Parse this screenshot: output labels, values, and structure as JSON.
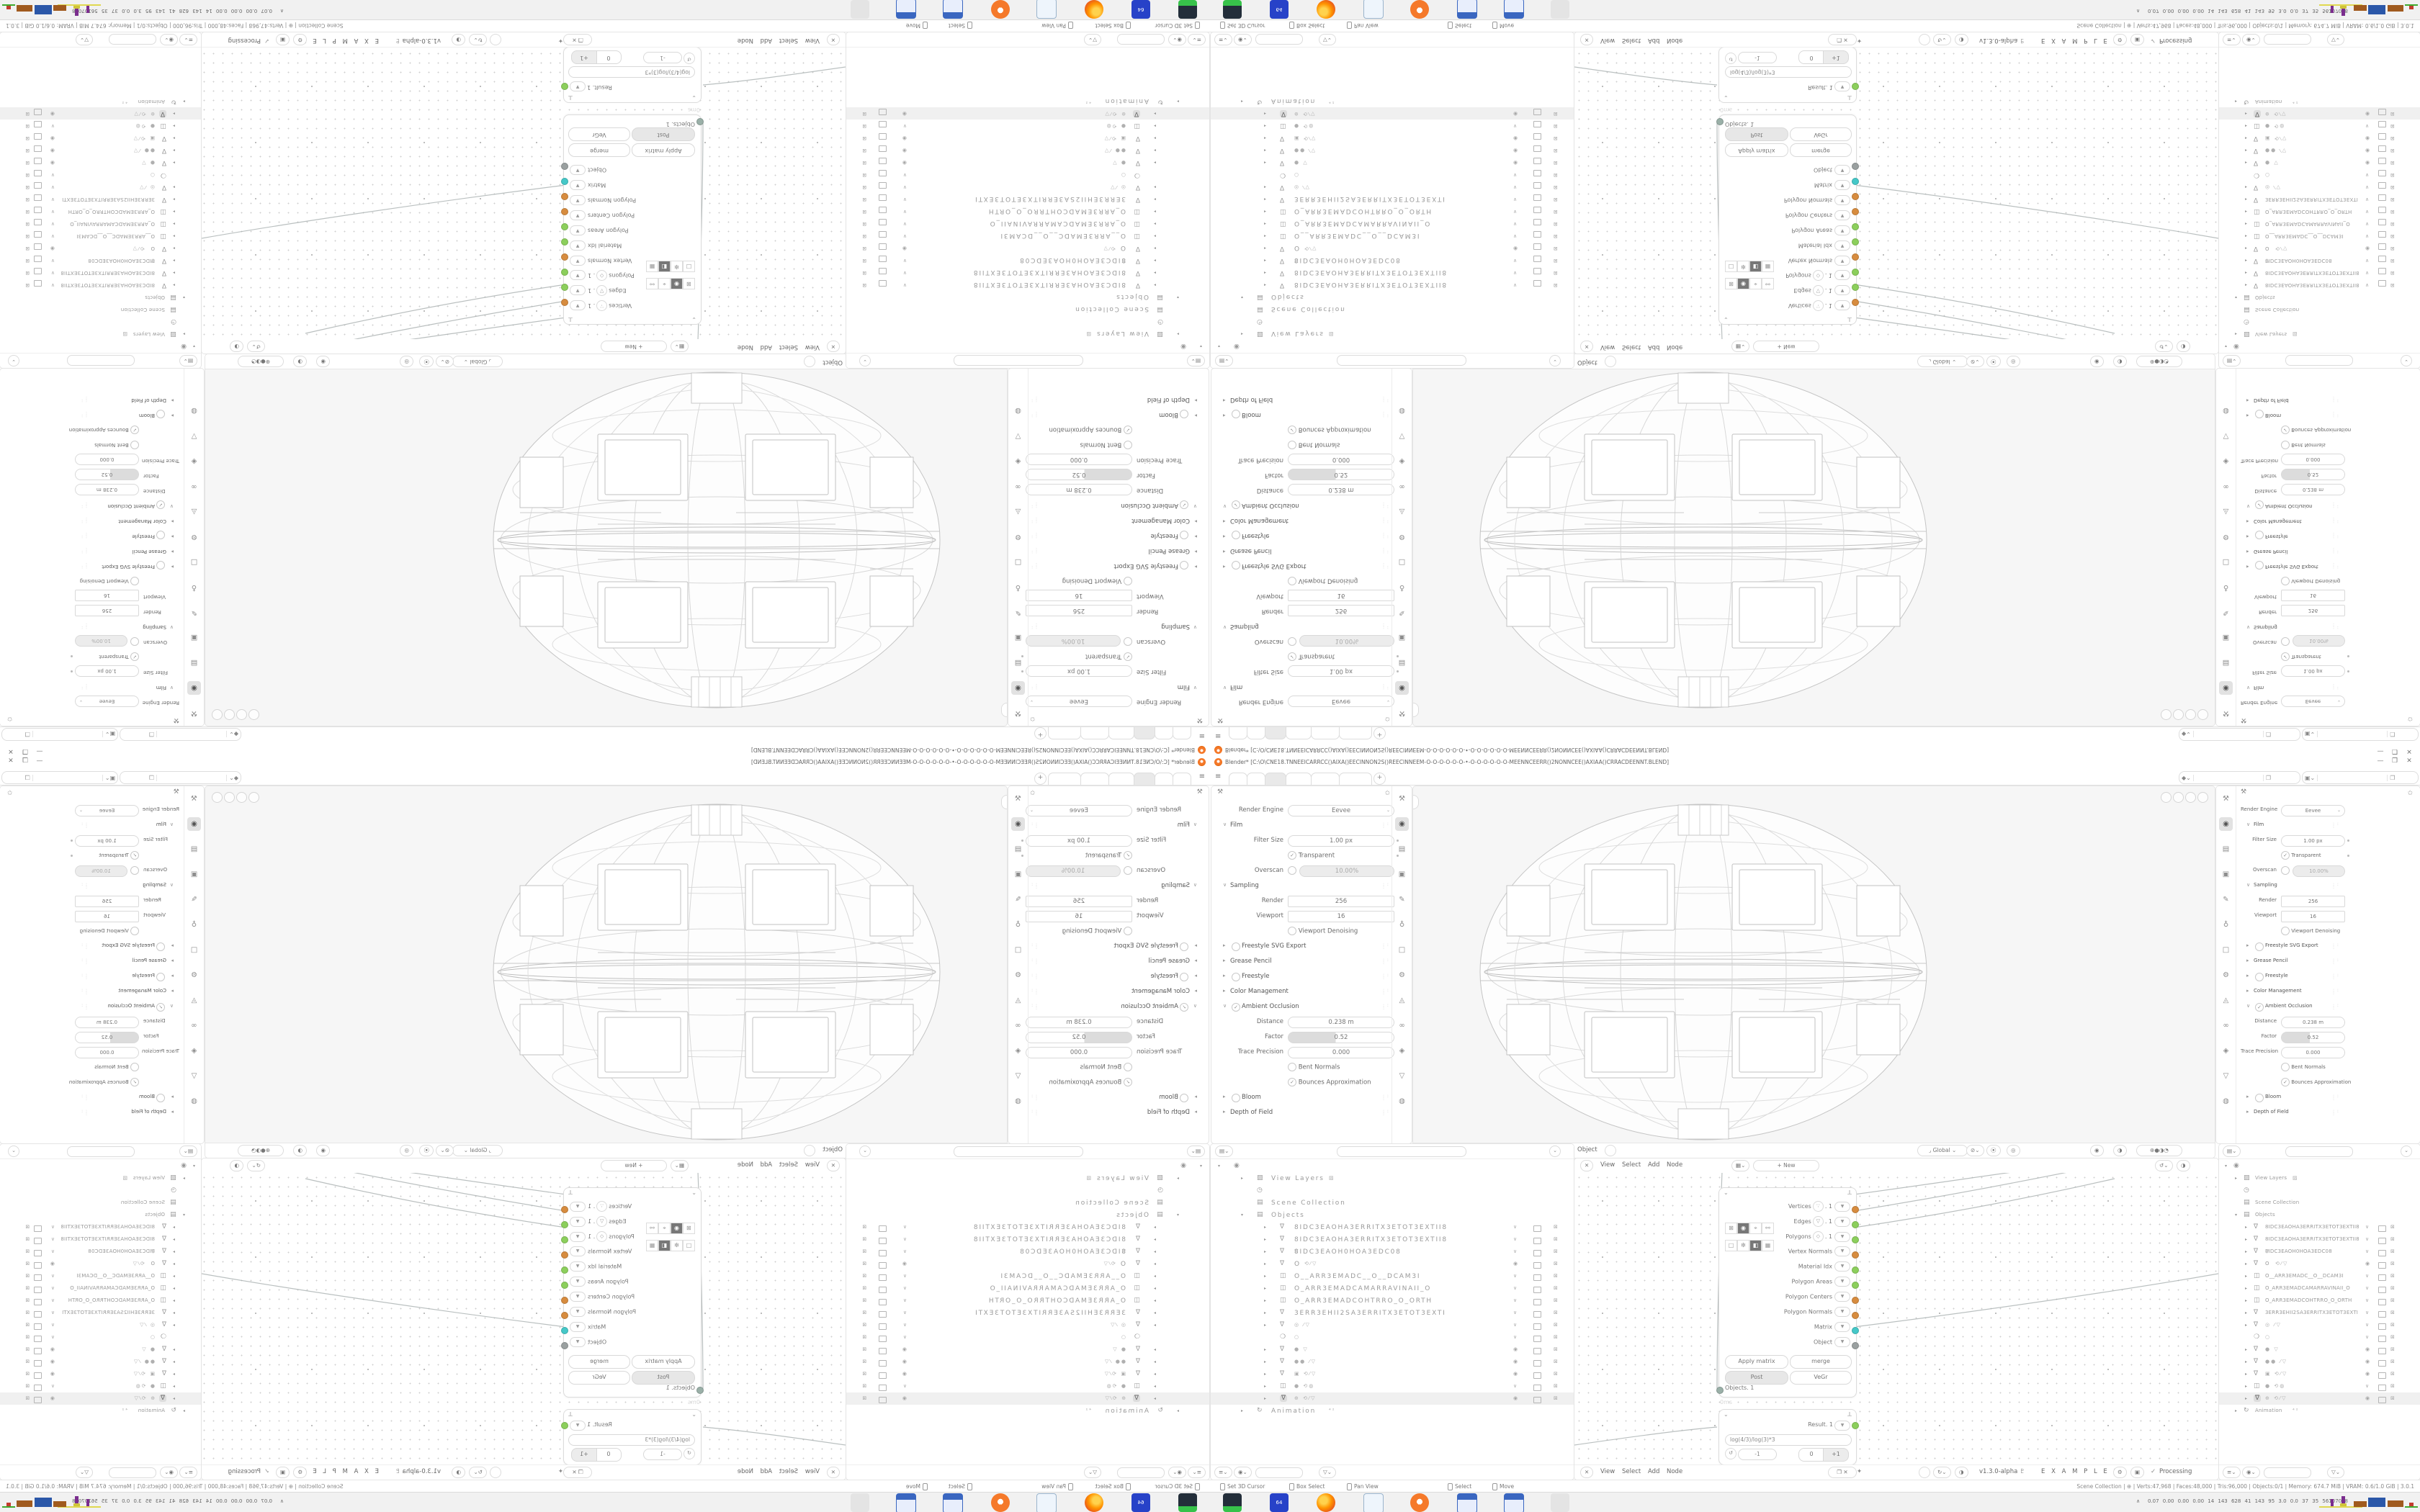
{
  "meta": {
    "app": "Blender 3.0.1",
    "composition": "2x2 mirrored tiling of one 1680x1050 Blender window",
    "quadrants": {
      "top_left": "rotated-180",
      "top_right": "flipped-vertical",
      "bottom_left": "flipped-horizontal",
      "bottom_right": "original"
    }
  },
  "colors": {
    "blender_orange": "#f5792a",
    "socket_orange": "#d78c3f",
    "socket_green": "#8ccf5c",
    "socket_teal": "#45c8c8",
    "socket_gray": "#9aa0a0",
    "taskbar_bg": "#f1f1f1",
    "area_border": "#e4e4e4"
  },
  "window": {
    "title": "Blender* [C:\\O\\CNE18.TNNEEICARRCC()AIXA()EECINNON2S()REECINNEEM-O-O-O-O-O-O-•-O-O-O-O-O-O-MEENNCEERR()2NONNCEE()AXIAA()CRRACDEENNT.BLEND]",
    "controls": {
      "minimize": "—",
      "restore": "❐",
      "close": "✕"
    }
  },
  "topbar": {
    "menu_icon": "≡",
    "tabs": [
      {
        "label": "",
        "active": false
      },
      {
        "label": "",
        "active": false
      },
      {
        "label": "",
        "active": true
      },
      {
        "label": "",
        "active": false
      },
      {
        "label": "",
        "active": false
      },
      {
        "label": "",
        "active": false
      }
    ],
    "add_tab": "+",
    "scene_selector": {
      "value": "",
      "icon": "scene-icon",
      "copy_icon": "copy-icon"
    },
    "viewlayer_selector": {
      "value": "",
      "icon": "viewlayer-icon",
      "copy_icon": "copy-icon"
    }
  },
  "icons": {
    "chev": "⌄",
    "pin": "✩",
    "pin_filled": "✦",
    "tool": "⚒",
    "grip": ": : :",
    "editor": "✙",
    "snap": "⚓",
    "magnet": "⦿",
    "proportional": "◎",
    "overlay1": "◉",
    "overlay2": "◑",
    "shading": "⊕●◑◔",
    "tree_x": "✕",
    "dna": "♇",
    "check": "✓",
    "copy": "❐",
    "reset": "↺",
    "wrench": "⟂"
  },
  "props": {
    "tab_icons": [
      "tool",
      "render",
      "output",
      "viewlayer",
      "scene",
      "world",
      "object",
      "modifiers",
      "particles",
      "physics",
      "constraints",
      "data",
      "material"
    ],
    "tab_glyphs": {
      "tool": "⚒",
      "render": "◉",
      "output": "▤",
      "viewlayer": "▣",
      "scene": "✎",
      "world": "♁",
      "object": "□",
      "modifiers": "⚙",
      "particles": "◬",
      "physics": "∞",
      "constraints": "◈",
      "data": "▽",
      "material": "◍"
    },
    "active_tab": "render",
    "rows": [
      {
        "type": "engine",
        "label": "Render Engine",
        "value": "Eevee"
      },
      {
        "type": "section",
        "state": "open",
        "label": "Film",
        "grips": true
      },
      {
        "type": "field",
        "label": "Filter Size",
        "value": "1.00 px",
        "dot": true
      },
      {
        "type": "check",
        "label": "Transparent",
        "checked": true,
        "dot": true
      },
      {
        "type": "radiofield",
        "label": "Overscan",
        "value": "10.00%"
      },
      {
        "type": "section",
        "state": "open",
        "label": "Sampling",
        "grips": true
      },
      {
        "type": "field",
        "label": "Render",
        "value": "256",
        "square": true
      },
      {
        "type": "field",
        "label": "Viewport",
        "value": "16",
        "square": true
      },
      {
        "type": "subcheck",
        "label": "Viewport Denoising",
        "checked": false
      },
      {
        "type": "section",
        "state": "closed",
        "toggle": "circle",
        "label": "Freestyle SVG Export",
        "grips": true
      },
      {
        "type": "section",
        "state": "closed",
        "label": "Grease Pencil",
        "grips": true
      },
      {
        "type": "section",
        "state": "closed",
        "toggle": "circle",
        "label": "Freestyle",
        "grips": true
      },
      {
        "type": "section",
        "state": "closed",
        "label": "Color Management",
        "grips": true
      },
      {
        "type": "section",
        "state": "open",
        "toggle": "check",
        "label": "Ambient Occlusion",
        "grips": true
      },
      {
        "type": "field",
        "label": "Distance",
        "value": "0.238 m"
      },
      {
        "type": "slider",
        "label": "Factor",
        "value": "0.52"
      },
      {
        "type": "field",
        "label": "Trace Precision",
        "value": "0.000"
      },
      {
        "type": "subcheck",
        "label": "Bent Normals",
        "checked": false
      },
      {
        "type": "subcheck",
        "label": "Bounces Approximation",
        "checked": true
      },
      {
        "type": "section",
        "state": "closed",
        "toggle": "circle",
        "label": "Bloom",
        "grips": true
      },
      {
        "type": "section",
        "state": "closed",
        "label": "Depth of Field",
        "grips": true
      }
    ]
  },
  "viewport": {
    "header": {
      "mode": "Object Mode",
      "menus": [
        "View",
        "Select",
        "Add",
        "Object"
      ],
      "orientation": "Global"
    },
    "object": "wireframe paneled sphere"
  },
  "node_editor": {
    "menus": [
      "View",
      "Select",
      "Add",
      "Node"
    ],
    "new_button": "+ New",
    "footer": {
      "version": "v1.3.0-alpha",
      "tree_name": "E X A M P L E S",
      "status": "Processing"
    },
    "node_main": {
      "buttons": [
        [
          "Apply matrix",
          "merge"
        ],
        [
          "Post",
          "VeGr"
        ]
      ],
      "pressed": "Post",
      "input_socket": {
        "label": "Objects. 1",
        "color": "#9ab0a8"
      },
      "time": "0ms",
      "sockets": [
        {
          "label": "Vertices",
          "circ": "∵",
          "suffix": ". 1",
          "color": "#d78c3f"
        },
        {
          "label": "Edges",
          "circ": "▽",
          "suffix": ". 1",
          "color": "#8ccf5c"
        },
        {
          "label": "Polygons",
          "circ": "◇",
          "suffix": ". 1",
          "color": "#8ccf5c"
        },
        {
          "label": "Vertex Normals",
          "color": "#d78c3f"
        },
        {
          "label": "Material Idx",
          "color": "#8ccf5c"
        },
        {
          "label": "Polygon Areas",
          "color": "#8ccf5c"
        },
        {
          "label": "Polygon Centers",
          "color": "#d78c3f"
        },
        {
          "label": "Polygon Normals",
          "color": "#d78c3f"
        },
        {
          "label": "Matrix",
          "color": "#45c8c8"
        },
        {
          "label": "Object",
          "color": "#9aa0a0"
        }
      ],
      "toggles_a": [
        "⊠",
        "◉",
        "⌖",
        "⚯"
      ],
      "toggles_b": [
        "□",
        "❇",
        "◧",
        "▦"
      ]
    },
    "node_expr": {
      "result_label": "Result. 1",
      "result_color": "#8ccf5c",
      "expression": "log(4/3)/log(3)*3",
      "value_minus": "-1",
      "step": [
        "0",
        "+1"
      ]
    }
  },
  "outliner": {
    "rows": [
      {
        "d": 0,
        "a": "▾",
        "icon": "user",
        "name": ""
      },
      {
        "d": 1,
        "a": "▸",
        "icon": "image",
        "name": "View Layers",
        "badge": "▨"
      },
      {
        "d": 1,
        "a": "",
        "icon": "clock",
        "name": ""
      },
      {
        "d": 1,
        "a": "",
        "icon": "collection",
        "name": "Scene Collection"
      },
      {
        "d": 1,
        "a": "▾",
        "icon": "collection",
        "name": "Objects"
      },
      {
        "d": 2,
        "a": "▸",
        "icon": "mesh",
        "name": "8IDC3EAOHA3ERRITX3ETOT3EXTII8",
        "t": "chk"
      },
      {
        "d": 2,
        "a": "▸",
        "icon": "mesh",
        "name": "8IDC3EAOHA3ERRITX3ETOT3EXTII8",
        "t": "chk"
      },
      {
        "d": 2,
        "a": "▸",
        "icon": "mesh",
        "name": "8IDC3EAOH0HOA3EDC08",
        "mid": "▽",
        "t": "chk"
      },
      {
        "d": 2,
        "a": "▸",
        "icon": "mesh",
        "name": "O",
        "mid": "⟲⁄▽",
        "t": "dot"
      },
      {
        "d": 2,
        "a": "▸",
        "icon": "group",
        "name": "O__ARR3EMADC__O__DCAM3I",
        "t": "chk"
      },
      {
        "d": 2,
        "a": "▸",
        "icon": "group",
        "name": "O_ARR3EMADCAMARRAVINAII_O",
        "t": "chk"
      },
      {
        "d": 2,
        "a": "▸",
        "icon": "group",
        "name": "O_ARR3EMADCOHTRRO_O_ORTH",
        "t": "chk"
      },
      {
        "d": 2,
        "a": "▸",
        "icon": "mesh",
        "name": "3ERR3EHII2SA3ERRITX3ETOT3EXTI",
        "t": "chk"
      },
      {
        "d": 2,
        "a": "▸",
        "icon": "mesh",
        "name": "",
        "mid": "◎ ⁄▽",
        "t": "chk"
      },
      {
        "d": 2,
        "a": "",
        "icon": "lamp",
        "name": "",
        "mid": "○",
        "t": "chk"
      },
      {
        "d": 2,
        "a": "▸",
        "icon": "mesh",
        "name": "",
        "mid": "● ▽",
        "t": "dot"
      },
      {
        "d": 2,
        "a": "▸",
        "icon": "mesh",
        "name": "",
        "mid": "●● ⁄▽",
        "t": "dot"
      },
      {
        "d": 2,
        "a": "▸",
        "icon": "mesh",
        "name": "",
        "mid": "▣ ⟲⁄▽",
        "t": "dot"
      },
      {
        "d": 2,
        "a": "▸",
        "icon": "group",
        "name": "",
        "mid": "● ⟲◍",
        "t": "chk"
      },
      {
        "d": 2,
        "a": "▸",
        "icon": "mesh",
        "name": "",
        "mid": "⊕ ⟲⁄▽",
        "t": "dot",
        "sel": true
      },
      {
        "d": 1,
        "a": "▸",
        "icon": "anim",
        "name": "Animation",
        "badge": "⁴²"
      }
    ],
    "icon_glyphs": {
      "user": "◉",
      "image": "▨",
      "clock": "◷",
      "collection": "▤",
      "mesh": "∇",
      "group": "◫",
      "lamp": "❍",
      "anim": "↻"
    },
    "toggle_glyphs": {
      "chk": "∨",
      "dot": "◉",
      "cam": "⊠"
    }
  },
  "status": {
    "left": [
      {
        "label": "Set 3D Cursor"
      },
      {
        "label": "Box Select"
      },
      {
        "label": "Pan View"
      },
      {
        "label": "Select"
      },
      {
        "label": "Move"
      }
    ],
    "right": "Scene Collection | ⊕ | Verts:47,968 | Faces:48,000 | Tris:96,000 | Objects:0/1 | Memory: 674.7 MiB | VRAM: 0.6/1.0 GiB | 3.0.1"
  },
  "taskbar": {
    "icons": [
      "terminal",
      "hxd-64",
      "firefox",
      "notepad",
      "blender",
      "calculator",
      "calculator",
      "inactive-tool"
    ],
    "hxd_label": "64",
    "tray_expand": "∧",
    "tray_numbers": "0.07 0.00 0.00 0.00  14  143  628  41  143  95  3.0  0.0  37  35  56107028"
  }
}
